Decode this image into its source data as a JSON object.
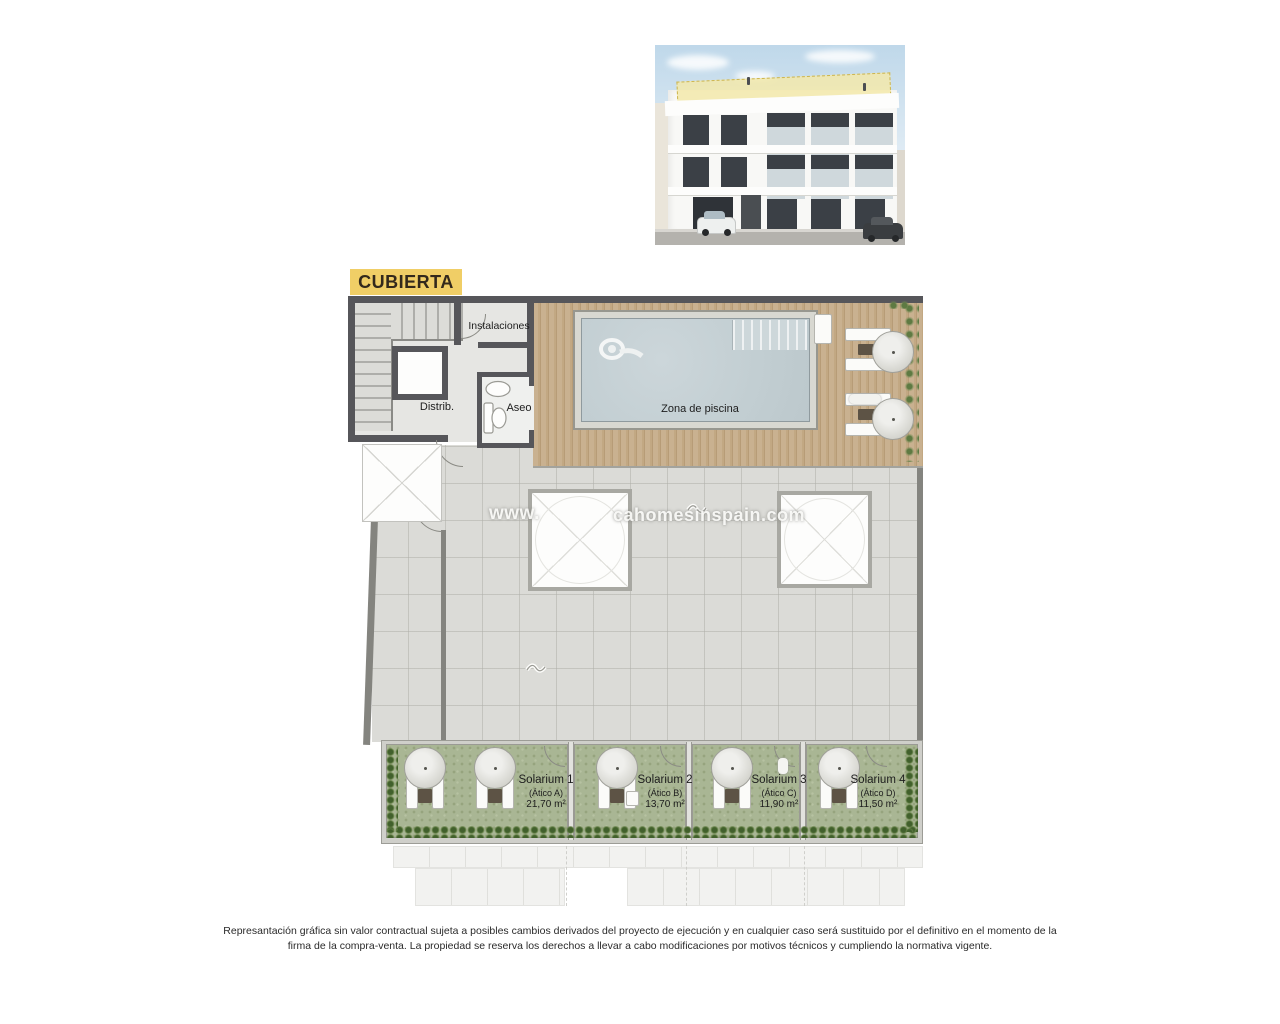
{
  "title": {
    "label": "CUBIERTA"
  },
  "plan": {
    "labels": {
      "instalaciones": "Instalaciones",
      "distrib": "Distrib.",
      "aseo": "Aseo",
      "pool": "Zona de piscina"
    },
    "watermark": {
      "prefix": "www.",
      "suffix": "cahomesinspain.com"
    },
    "solariums": [
      {
        "name": "Solarium 1",
        "unit": "(Ático A)",
        "area": "21,70 m²"
      },
      {
        "name": "Solarium 2",
        "unit": "(Ático B)",
        "area": "13,70 m²"
      },
      {
        "name": "Solarium 3",
        "unit": "(Ático C)",
        "area": "11,90 m²"
      },
      {
        "name": "Solarium 4",
        "unit": "(Ático D)",
        "area": "11,50 m²"
      }
    ]
  },
  "footer": {
    "line1": "Represantación gráfica sin valor contractual sujeta a posibles cambios derivados del proyecto de ejecución y en cualquier caso será sustituido por el definitivo en el momento de la",
    "line2": "firma de la compra-venta. La propiedad se reserva los derechos a llevar a cabo modificaciones por motivos técnicos y cumpliendo la normativa vigente."
  },
  "colors": {
    "title_bg": "#f0ce66",
    "wall_dark": "#56565a",
    "deck_wood": "#c3a988",
    "pool_water": "#c6d1d5",
    "terrace": "#dbdbd7",
    "turf": "#a9b694",
    "plant_dark": "#4f6b33",
    "sky": "#bfd8ea"
  }
}
